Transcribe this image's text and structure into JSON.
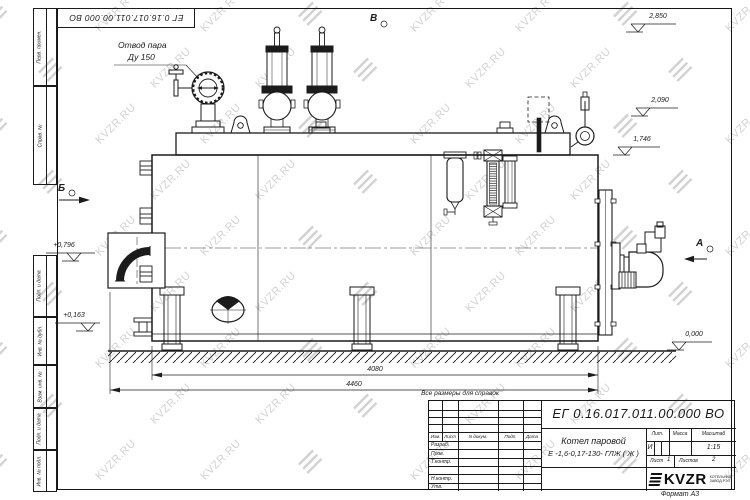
{
  "watermark": {
    "text": "KVZR.RU"
  },
  "stamp_top": {
    "doc_number_rotated": "ЕГ 0.16.017.011.00.000 ВО"
  },
  "side_columns": {
    "upper": [
      "Перв. примен.",
      "Справ. №"
    ],
    "lower": [
      "Подп. и дата",
      "Инв. № дубл.",
      "Взам. инв. №",
      "Подп. и дата",
      "Инв. № подл."
    ]
  },
  "drawing": {
    "labels": {
      "steam_outlet_line1": "Отвод пара",
      "steam_outlet_line2": "Ду 150",
      "view_a": "А",
      "view_b": "Б",
      "view_v": "В"
    },
    "elevations": {
      "right": [
        "2,850",
        "2,090",
        "1,746"
      ],
      "left": [
        "+0,796",
        "+0,163"
      ],
      "ground": "0,000"
    },
    "dimensions": {
      "inner": "4080",
      "outer": "4460"
    },
    "note": "Все размеры для справок"
  },
  "title_block": {
    "doc_number": "ЕГ 0.16.017.011.00.000  ВО",
    "product_name_line1": "Котел паровой",
    "product_name_line2": "Е -1,6-0,17-130- ГЛЖ ( Ж )",
    "header_row": [
      "Изм.",
      "Лист",
      "N докум.",
      "Подп.",
      "Дата"
    ],
    "rows": [
      "Разраб.",
      "Пров.",
      "Т.контр.",
      "Н.контр.",
      "Утв."
    ],
    "lit_header": "Лит.",
    "mass_header": "Масса",
    "scale_header": "Масштаб",
    "lit_value": "И",
    "scale_value": "1:15",
    "sheet_label": "Лист",
    "sheet_value": "1",
    "sheets_label": "Листов",
    "sheets_value": "2",
    "logo_text": "KVZR",
    "logo_sub1": "КОТЕЛЬНЫЙ",
    "logo_sub2": "ЗАВОД РЭП",
    "format_label": "Формат А3"
  }
}
